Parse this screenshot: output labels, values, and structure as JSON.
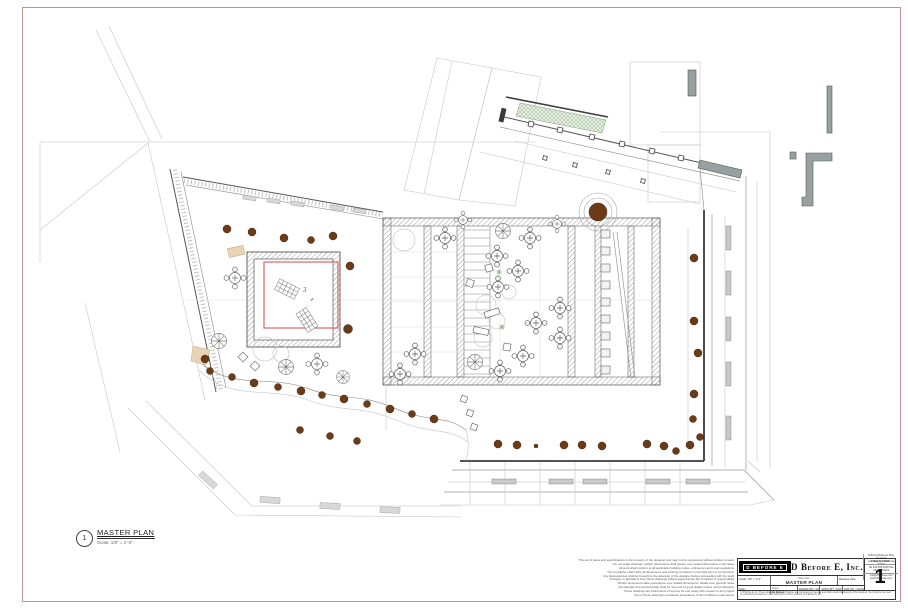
{
  "sheet": {
    "border_color": "#c49091",
    "background": "#ffffff"
  },
  "drawing_callout": {
    "number": "1",
    "title": "MASTER PLAN",
    "scale": "Scale: 1/8\" = 1'-0\""
  },
  "plan": {
    "chaise_area_label": "3",
    "colors": {
      "tree_brown": "#6b3a17",
      "accent_red": "#d96464",
      "landscape_green": "#8fae8a",
      "wall_gray": "#97a1a1",
      "planting_tan": "#e8d3b4"
    }
  },
  "notes_block": {
    "lines": [
      "This set of plans and specifications is the property of the designer and may not be reproduced without written consent.",
      "Do not scale drawings; written dimensions shall govern over scaled dimensions in all cases.",
      "All work shall conform to all applicable building codes, ordinances and local regulations.",
      "The contractor shall verify all dimensions and existing conditions in the field prior to construction.",
      "Any discrepancies shall be brought to the attention of the designer before proceeding with the work.",
      "Changes or deviations from these drawings without approval are the contractor's responsibility.",
      "Written dimensions take precedence over scaled dimensions; details over general notes.",
      "All materials and workmanship shall be new and of good quality unless noted otherwise.",
      "These drawings are instruments of service for use solely with respect to this project.",
      "Use of these drawings constitutes acceptance of all conditions noted herein."
    ]
  },
  "title_block": {
    "logo_text": "D BEFORE E",
    "company_name": "D Before E, Inc.",
    "address_lines": [
      "1234 Architecture Way, Studio 5",
      "Los Angeles, California 90000",
      "Tel 310.555.0100  Fax 310.555.0101"
    ],
    "contact_lines": [
      "info@dbeforee.com",
      "www.dbeforee.com"
    ],
    "fields": {
      "scale": "Scale: 1/8\" = 1'-0\"",
      "date_label": "Date:",
      "sheet_title_label": "Sheet title:",
      "sheet_title": "MASTER PLAN",
      "release_label": "Release date:",
      "scale_note_label": "Scale:",
      "scale_note_value": "As Noted",
      "drawn_label": "DRAWN BY / DATE",
      "approved_label": "APP'D BY / DATE",
      "job_label": "JOB NO. / DATE"
    },
    "sheet_number_label": "SHEET NUMBER",
    "sheet_number": "1",
    "footer_note": "© D Before E, Inc.  These drawings and specifications are instruments of service and shall remain the property of the designer; they shall not be used or reproduced in whole or in part without prior written consent of D Before E, Inc."
  }
}
